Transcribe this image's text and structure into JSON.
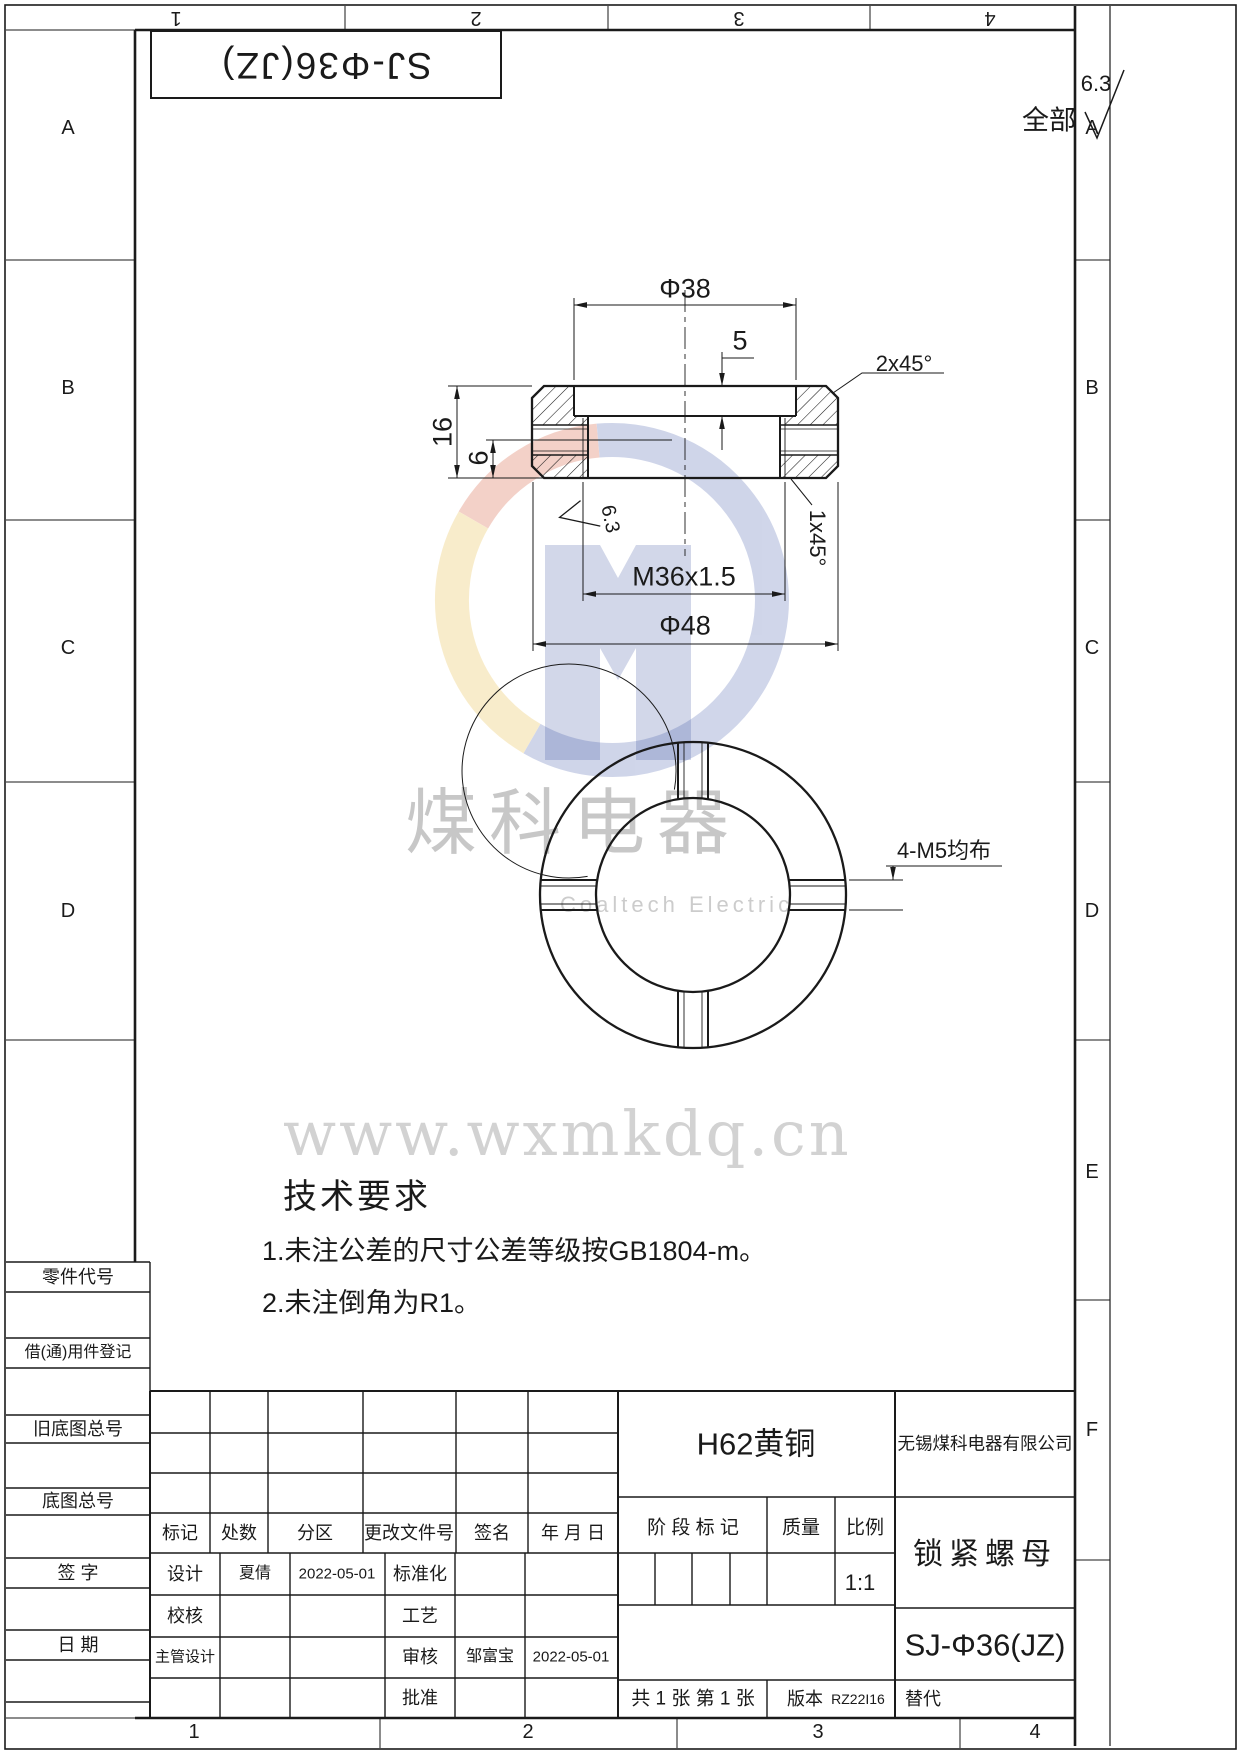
{
  "zones": {
    "top": [
      "1",
      "2",
      "3",
      "4"
    ],
    "bottom": [
      "1",
      "2",
      "3",
      "4"
    ],
    "left": [
      "A",
      "B",
      "C",
      "D"
    ],
    "right": [
      "A",
      "B",
      "C",
      "D",
      "E",
      "F"
    ]
  },
  "header": {
    "flipped_part_number": "SJ-Φ36(JZ)",
    "finish_scope": "全部",
    "finish_value": "6.3"
  },
  "section_view": {
    "dim_phi38": "Φ38",
    "dim_step_depth": "5",
    "dim_height": "16",
    "dim_m5_height": "6",
    "chamfer_top": "2x45°",
    "chamfer_bottom": "1x45°",
    "finish_value": "6.3",
    "dim_thread": "M36x1.5",
    "dim_phi48": "Φ48"
  },
  "front_view": {
    "holes_label": "4-M5均布"
  },
  "watermark": {
    "brand_cn": "煤科电器",
    "brand_en": "Coaltech Electric",
    "url": "www.wxmkdq.cn"
  },
  "tech_req": {
    "title": "技术要求",
    "item1": "1.未注公差的尺寸公差等级按GB1804-m。",
    "item2": "2.未注倒角为R1。"
  },
  "margin_boxes": {
    "part_code": "零件代号",
    "borrow_reg": "借(通)用件登记",
    "old_sheet_no": "旧底图总号",
    "sheet_no": "底图总号",
    "sign": "签 字",
    "date": "日 期"
  },
  "revision_table": {
    "h_mark": "标记",
    "h_count": "处数",
    "h_zone": "分区",
    "h_file": "更改文件号",
    "h_sign": "签名",
    "h_date": "年 月 日"
  },
  "sig_table": {
    "design_label": "设计",
    "design_name": "夏倩",
    "design_date": "2022-05-01",
    "standard_label": "标准化",
    "check_label": "校核",
    "process_label": "工艺",
    "chief_label": "主管设计",
    "audit_label": "审核",
    "audit_name": "邹富宝",
    "audit_date": "2022-05-01",
    "approve_label": "批准"
  },
  "title_block": {
    "material": "H62黄铜",
    "company": "无锡煤科电器有限公司",
    "stage_label": "阶 段 标 记",
    "mass_label": "质量",
    "scale_label": "比例",
    "scale_value": "1:1",
    "part_name": "锁紧螺母",
    "drawing_no": "SJ-Φ36(JZ)",
    "sheet_info": "共 1 张  第 1 张",
    "version_label": "版本",
    "version_value": "RZ22I16",
    "replace_label": "替代"
  }
}
